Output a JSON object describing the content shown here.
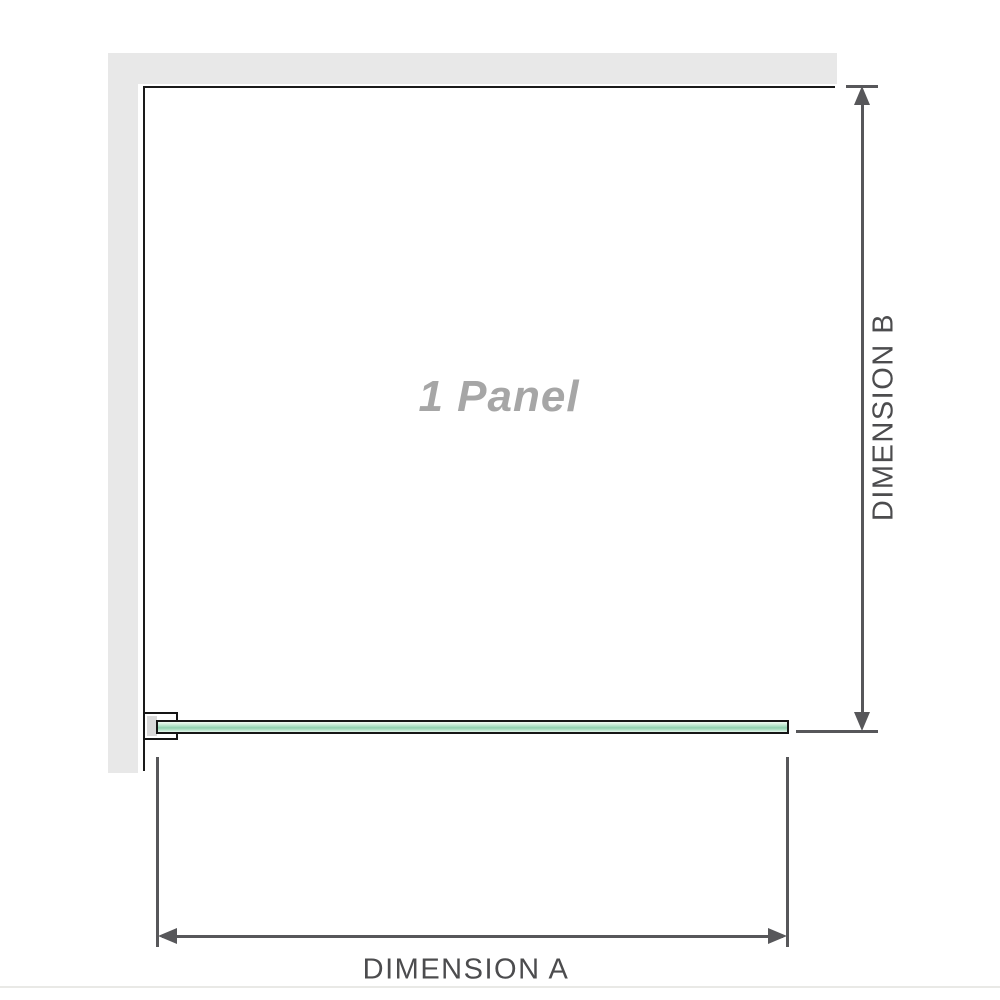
{
  "diagram": {
    "panel_label": "1 Panel",
    "dimension_a": {
      "label": "DIMENSION A"
    },
    "dimension_b": {
      "label": "DIMENSION B"
    },
    "colors": {
      "wall": "#e8e8e8",
      "outline": "#1a1a1a",
      "glass_green_light": "#cfeeda",
      "glass_green_dark": "#8fd0ae",
      "bracket_pad_gray": "#d9d9d9",
      "dimension_line": "#57575a",
      "dimension_text": "#4c4c4e",
      "panel_label_text": "#a6a6a6",
      "baseline": "#e9e9e6"
    }
  }
}
